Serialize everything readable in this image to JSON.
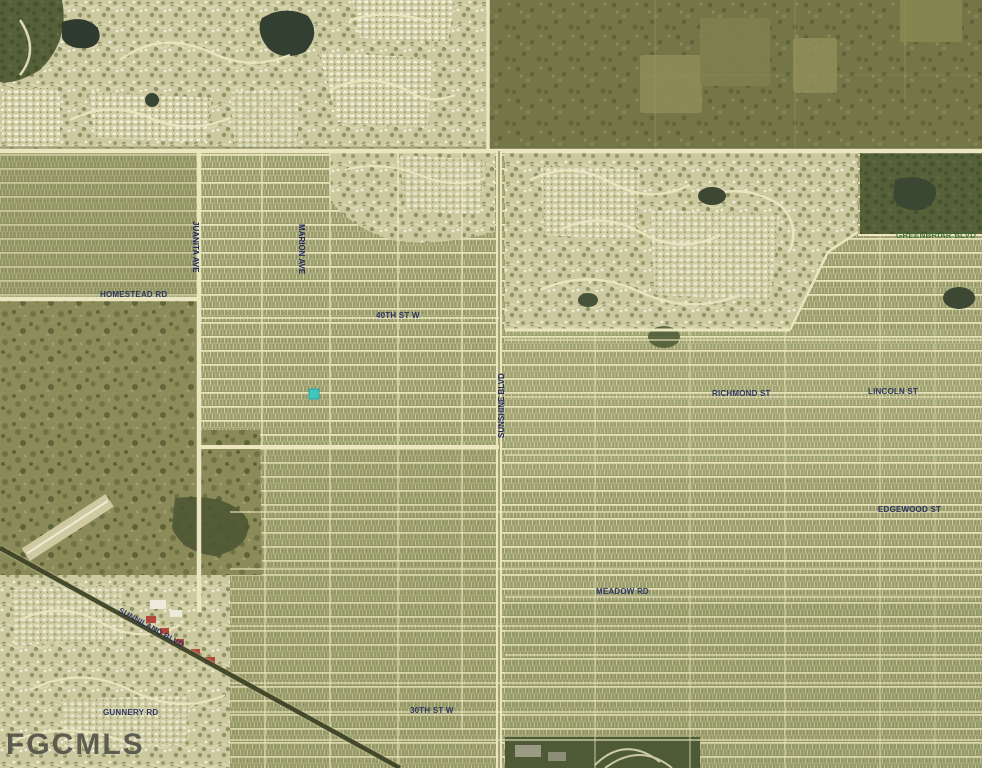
{
  "map": {
    "watermark": "FGCMLS",
    "marker": {
      "type": "subject-property",
      "shape": "square",
      "color": "#3fc6bd"
    },
    "palette": {
      "street_label": "#20285f",
      "area_label": "#3c6b35",
      "road_cream": "#ebe6bf",
      "terrain_olive": "#979c6a",
      "watermark_gray": "#3f4238"
    },
    "labels": {
      "homestead_rd": "HOMESTEAD RD",
      "juanita_ave": "JUANITA AVE",
      "marion_ave": "MARION AVE",
      "st_40th_w": "40TH ST W",
      "sunshine_blvd": "SUNSHINE BLVD",
      "richmond_st": "RICHMOND ST",
      "lincoln_st": "LINCOLN ST",
      "edgewood_st": "EDGEWOOD ST",
      "meadow_rd": "MEADOW RD",
      "sunniland_blvd": "SUNNILAND BLVD",
      "gunnery_rd": "GUNNERY RD",
      "st_30th_w": "30TH ST W",
      "greenbriar_blvd": "GREENBRIAR BLVD"
    }
  }
}
